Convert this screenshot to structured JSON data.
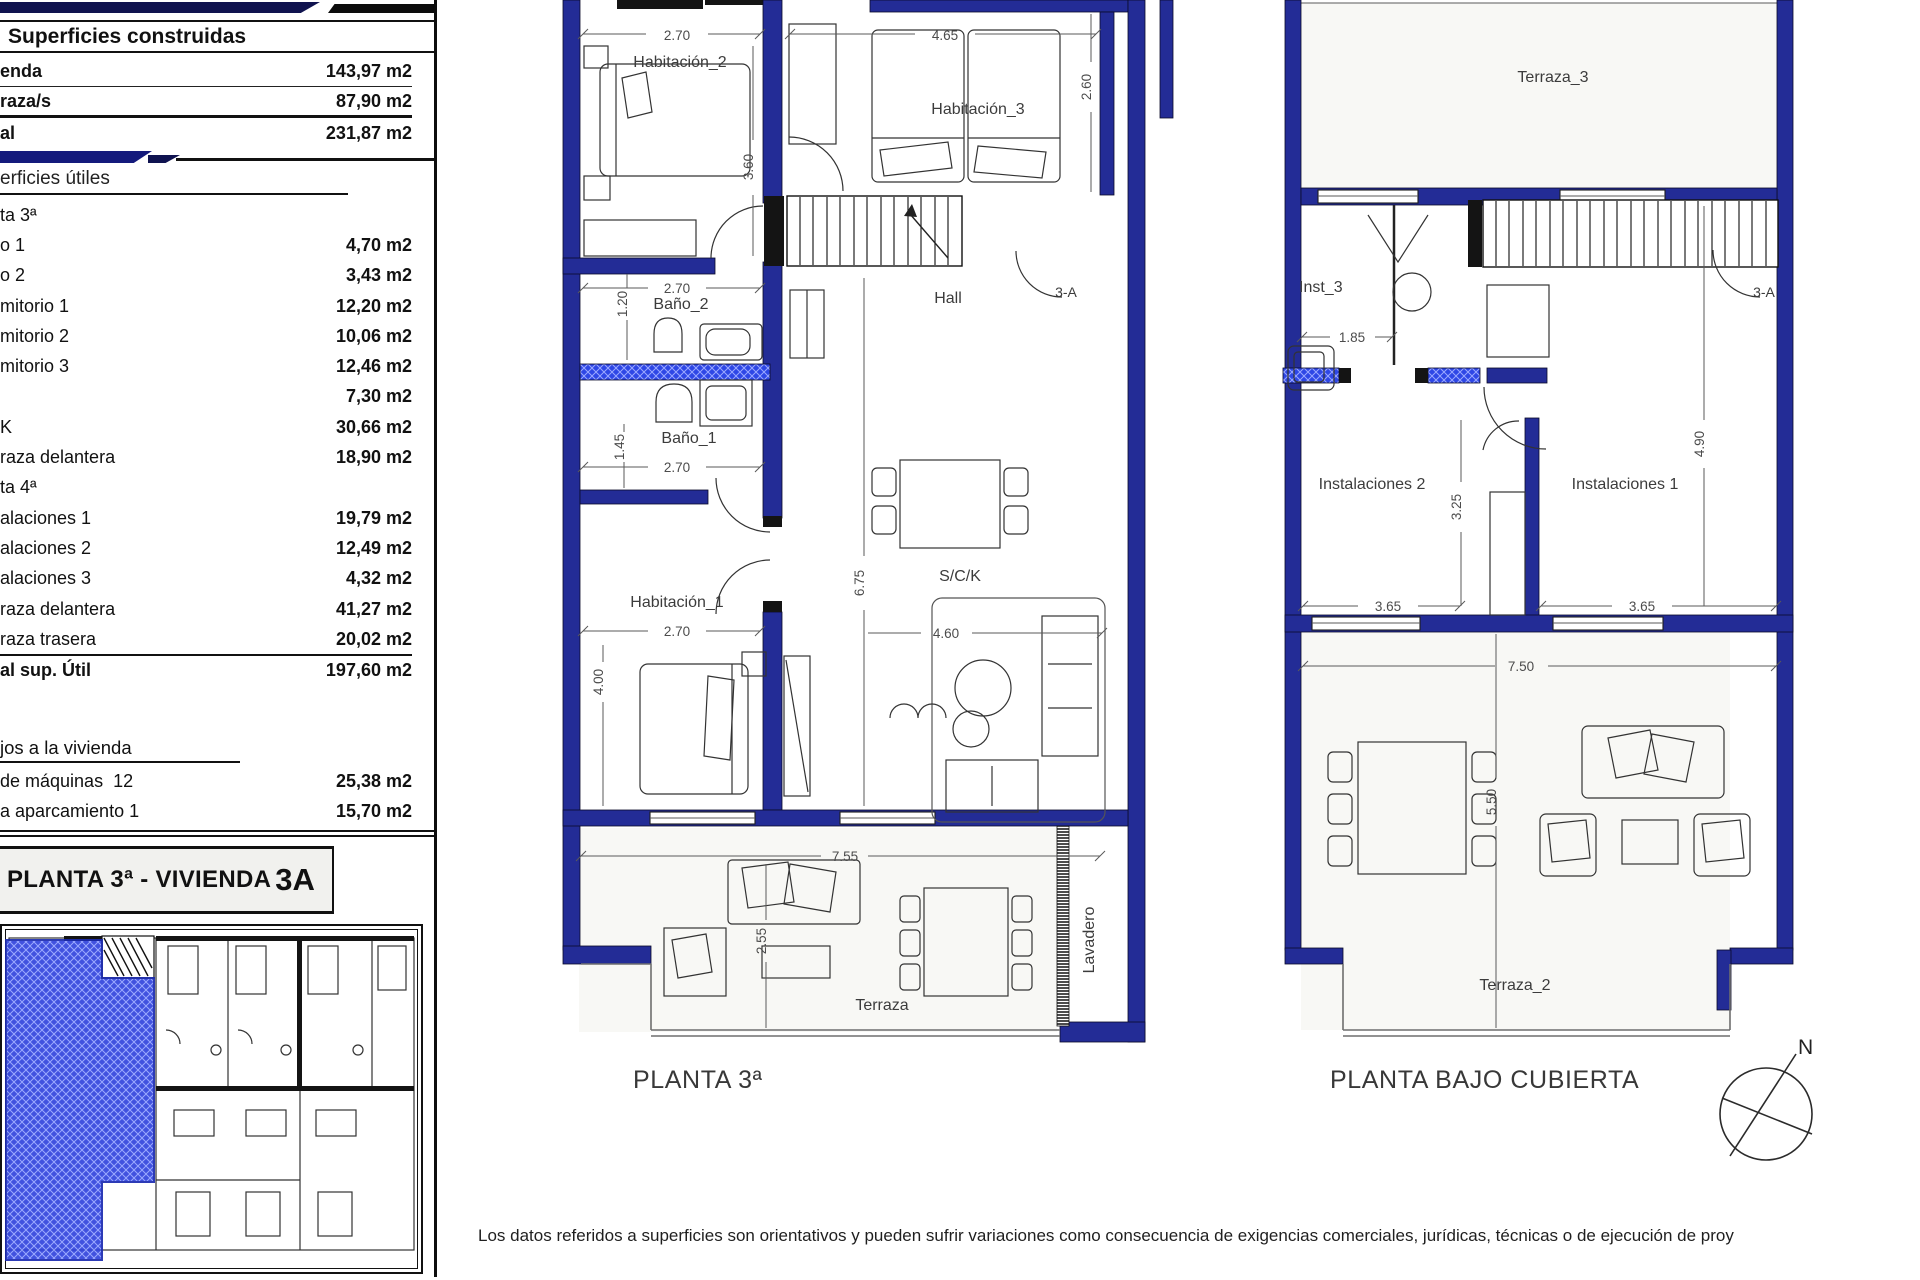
{
  "left_panel": {
    "built": {
      "header": "Superficies construidas",
      "rows": [
        {
          "label": "enda",
          "value": "143,97 m2"
        },
        {
          "label": "raza/s",
          "value": "87,90 m2"
        },
        {
          "label": "al",
          "value": "231,87 m2"
        }
      ]
    },
    "useful": {
      "header": "erficies útiles",
      "rows": [
        {
          "label": "ta 3ª",
          "value": "",
          "cls": "section"
        },
        {
          "label": "o 1",
          "value": "4,70 m2"
        },
        {
          "label": "o 2",
          "value": "3,43 m2"
        },
        {
          "label": "mitorio 1",
          "value": "12,20 m2"
        },
        {
          "label": "mitorio 2",
          "value": "10,06 m2"
        },
        {
          "label": "mitorio 3",
          "value": "12,46 m2"
        },
        {
          "label": "",
          "value": "7,30 m2"
        },
        {
          "label": "K",
          "value": "30,66 m2"
        },
        {
          "label": "raza delantera",
          "value": "18,90 m2"
        },
        {
          "label": "ta 4ª",
          "value": "",
          "cls": "section"
        },
        {
          "label": "alaciones 1",
          "value": "19,79 m2"
        },
        {
          "label": "alaciones 2",
          "value": "12,49 m2"
        },
        {
          "label": "alaciones 3",
          "value": "4,32 m2"
        },
        {
          "label": "raza delantera",
          "value": "41,27 m2"
        },
        {
          "label": "raza trasera",
          "value": "20,02 m2"
        },
        {
          "label": "al sup. Útil",
          "value": "197,60 m2",
          "cls": "total"
        }
      ]
    },
    "annex": {
      "header": "jos a la vivienda",
      "rows": [
        {
          "label": "de máquinas  12",
          "value": "25,38 m2"
        },
        {
          "label": "a aparcamiento 1",
          "value": "15,70 m2"
        }
      ]
    },
    "title": {
      "prefix": "PLANTA 3ª - VIVIENDA",
      "unit": "3A"
    }
  },
  "plan3": {
    "caption": "PLANTA 3ª",
    "unit": "3-A",
    "rooms": {
      "hab2": "Habitación_2",
      "hab3": "Habitación_3",
      "hall": "Hall",
      "bano2": "Baño_2",
      "bano1": "Baño_1",
      "hab1": "Habitación_1",
      "sck": "S/C/K",
      "terraza": "Terraza",
      "lavadero": "Lavadero"
    },
    "dims": {
      "hab2_w": "2.70",
      "hab3_w": "4.65",
      "hab2_h": "3.60",
      "hab3_h": "2.60",
      "bano2_w": "2.70",
      "bano2_h": "1.20",
      "bano1_w": "2.70",
      "bano1_h": "1.45",
      "hab1_w": "2.70",
      "hab1_h": "4.00",
      "sck_h": "6.75",
      "sck_w": "4.60",
      "terraza_w": "7.55",
      "terraza_h": "2.55"
    }
  },
  "plan_bc": {
    "caption": "PLANTA BAJO CUBIERTA",
    "unit": "3-A",
    "rooms": {
      "terraza3": "Terraza_3",
      "inst3": "Inst_3",
      "inst2": "Instalaciones 2",
      "inst1": "Instalaciones 1",
      "terraza2": "Terraza_2"
    },
    "dims": {
      "inst3_w": "1.85",
      "inst2_h": "3.25",
      "inst1_h": "4.90",
      "inst2_w": "3.65",
      "inst1_w": "3.65",
      "total_w": "7.50",
      "terraza2_h": "5.50"
    }
  },
  "compass": {
    "north": "N"
  },
  "footer": {
    "disclaimer": "Los datos referidos a superficies son orientativos y pueden sufrir variaciones como consecuencia de exigencias comerciales, jurídicas, técnicas o de ejecución de proy"
  }
}
